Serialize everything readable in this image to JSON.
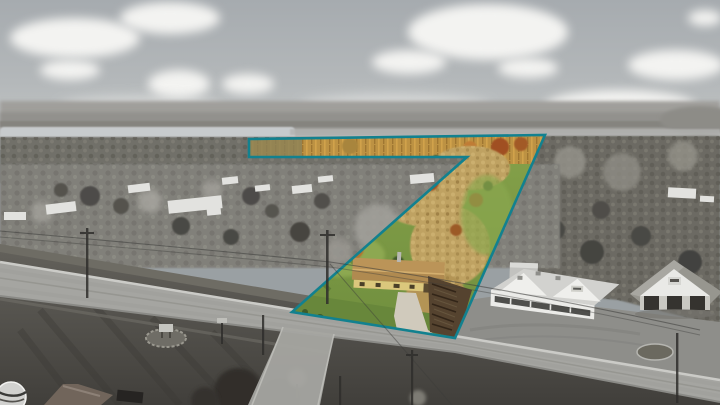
{
  "scene": {
    "labels": {
      "photo": "Aerial drone photograph of property, surroundings in grayscale",
      "parcel": "Color-highlighted property parcel",
      "boundary": "Teal property boundary outline",
      "parcel_house": "Ranch house with driveway inside parcel",
      "marsh_strip": "Golden marsh strip at rear of parcel",
      "lake": "Lake on horizon",
      "store_building": "Commercial store building",
      "garage_building": "Three-bay garage building",
      "main_road": "Main highway in foreground",
      "watermark": "Circular photographer watermark logo"
    },
    "colors": {
      "teal": "#12818F",
      "sky_top": "#A6ABAF",
      "sky_horizon": "#C6C9C8",
      "cloud": "#F3F3F1",
      "lake": "#C7CBCD",
      "grass": "#7D9C46",
      "grass_light": "#93AD55",
      "grass_front": "#68873B",
      "marsh_gold": "#BD9243",
      "autumn_orange": "#B4722D",
      "autumn_red": "#A04F22",
      "birch_tan": "#BFA262",
      "house_roof": "#B08A50",
      "house_wall": "#DBC77C",
      "driveway": "#D0CABC",
      "orchard": "#55432F",
      "road": "#A5A5A1",
      "road_edge": "#CBCBC7",
      "pavement": "#8E8E8A",
      "building_wall": "#EBEBE8",
      "building_roof": "#D2D2CF",
      "garage_roof": "#97968F",
      "forest": "#6C6A64",
      "nbhd": "#81807A",
      "lawn_fg": "#5E5C57",
      "hills": "#A09F9B"
    }
  }
}
